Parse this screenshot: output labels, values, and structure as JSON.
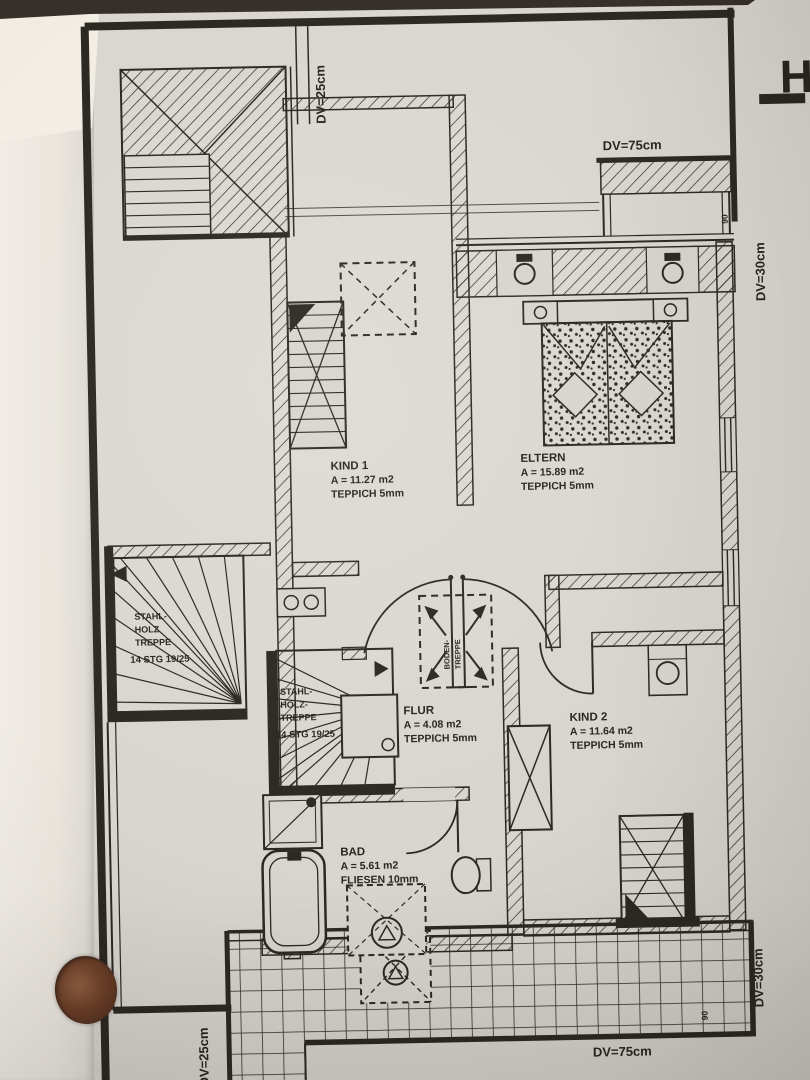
{
  "sheet": {
    "margin_glyph": "H",
    "dimensions": {
      "top_left": "DV=25cm",
      "top": "DV=75cm",
      "right_top": "DV=30cm",
      "right_bottom": "DV=30cm",
      "bottom": "DV=75cm",
      "bottom_left": "DV=25cm",
      "door_width_top": "90",
      "door_width_bottom": "90"
    },
    "rooms": {
      "kind1": {
        "name": "KIND 1",
        "area": "A = 11.27 m2",
        "flooring": "TEPPICH 5mm"
      },
      "eltern": {
        "name": "ELTERN",
        "area": "A = 15.89 m2",
        "flooring": "TEPPICH 5mm"
      },
      "flur": {
        "name": "FLUR",
        "area": "A = 4.08 m2",
        "flooring": "TEPPICH 5mm"
      },
      "kind2": {
        "name": "KIND 2",
        "area": "A = 11.64 m2",
        "flooring": "TEPPICH 5mm"
      },
      "bad": {
        "name": "BAD",
        "area": "A = 5.61 m2",
        "flooring": "FLIESEN 10mm"
      }
    },
    "stairs": {
      "left": {
        "l1": "STAHL-",
        "l2": "HOLZ",
        "l3": "TREPPE",
        "l4": "14 STG 19/25"
      },
      "middle": {
        "l1": "STAHL-",
        "l2": "HOLZ-",
        "l3": "TREPPE",
        "l4": "14 STG 19/25"
      }
    },
    "roof_hatch": {
      "l1": "BODEN-",
      "l2": "TREPPE"
    }
  },
  "colors": {
    "ink": "#2c2922",
    "paper": "#d8d4ce",
    "underlay": "#efebe4",
    "hole": "#6d4029"
  }
}
